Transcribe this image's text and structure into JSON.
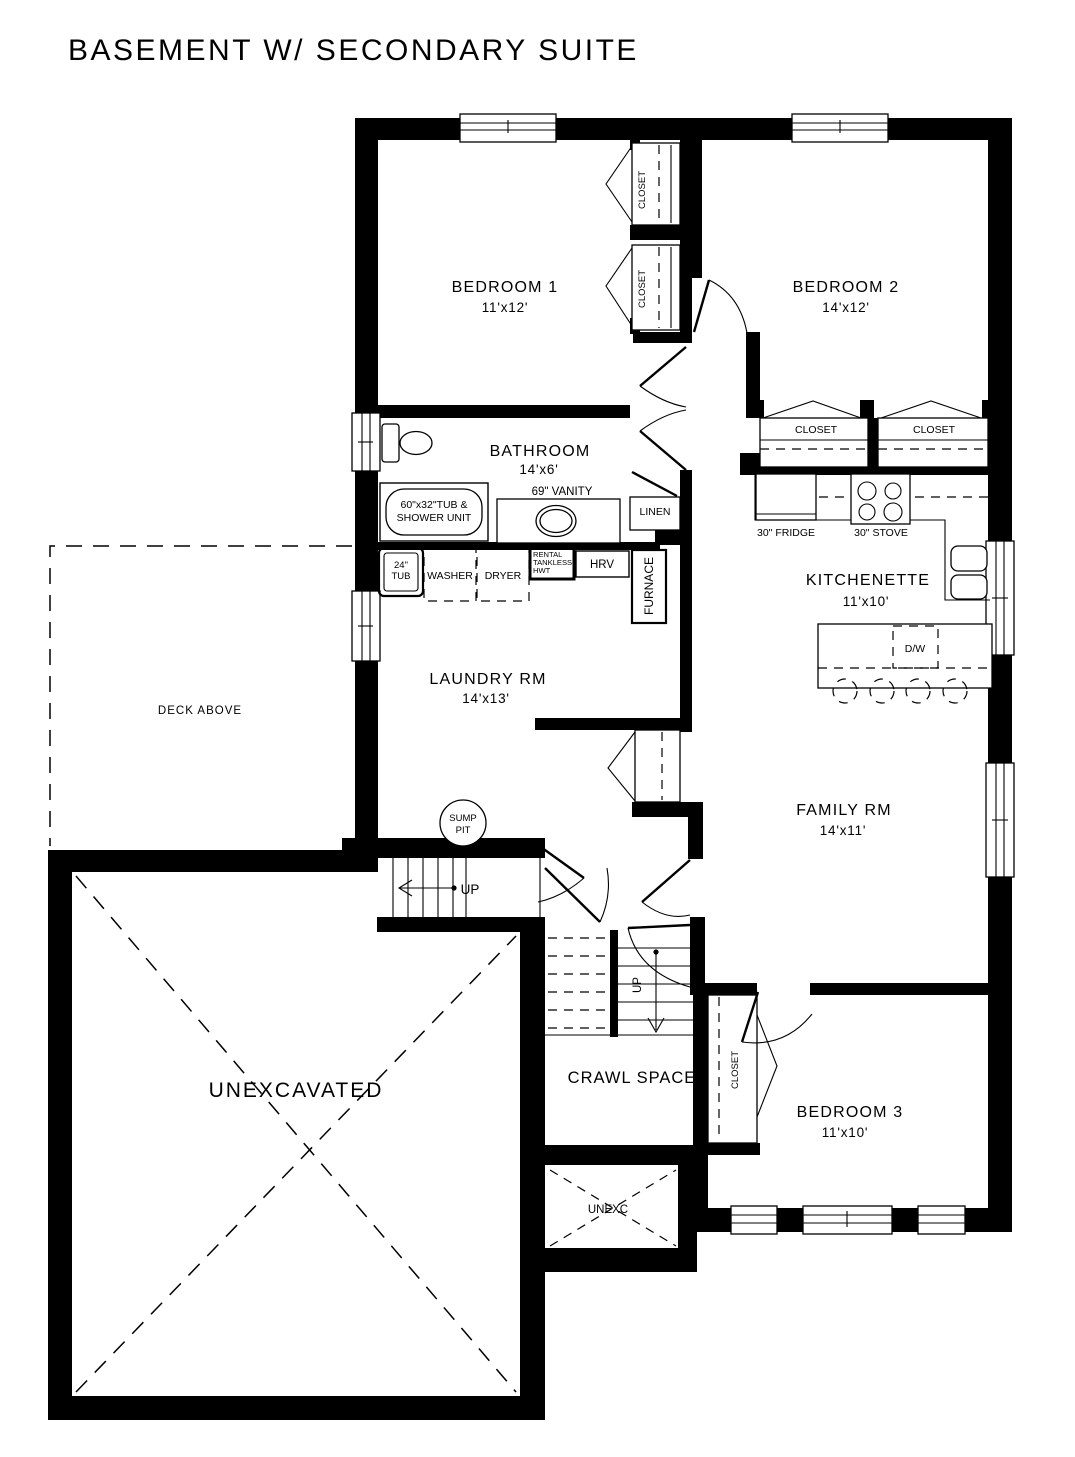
{
  "title": "BASEMENT W/ SECONDARY SUITE",
  "rooms": {
    "bedroom1": {
      "name": "BEDROOM 1",
      "dims": "11'x12'"
    },
    "bedroom2": {
      "name": "BEDROOM 2",
      "dims": "14'x12'"
    },
    "bathroom": {
      "name": "BATHROOM",
      "dims": "14'x6'"
    },
    "laundry": {
      "name": "LAUNDRY RM",
      "dims": "14'x13'"
    },
    "kitchenette": {
      "name": "KITCHENETTE",
      "dims": "11'x10'"
    },
    "family": {
      "name": "FAMILY RM",
      "dims": "14'x11'"
    },
    "bedroom3": {
      "name": "BEDROOM 3",
      "dims": "11'x10'"
    },
    "crawlspace": {
      "name": "CRAWL SPACE"
    },
    "unexcavated": {
      "name": "UNEXCAVATED"
    },
    "unexc_small": {
      "name": "UNEXC"
    },
    "deck": {
      "name": "DECK ABOVE"
    }
  },
  "labels": {
    "closet": "CLOSET",
    "linen": "LINEN",
    "vanity": "69\" VANITY",
    "tub_shower_line1": "60\"x32\"TUB &",
    "tub_shower_line2": "SHOWER UNIT",
    "tub24_line1": "24\"",
    "tub24_line2": "TUB",
    "washer": "WASHER",
    "dryer": "DRYER",
    "hwt_line1": "RENTAL",
    "hwt_line2": "TANKLESS",
    "hwt_line3": "HWT",
    "hrv": "HRV",
    "furnace": "FURNACE",
    "fridge": "30\" FRIDGE",
    "stove": "30\" STOVE",
    "dishwasher": "D/W",
    "sump_line1": "SUMP",
    "sump_line2": "PIT",
    "up": "UP"
  }
}
